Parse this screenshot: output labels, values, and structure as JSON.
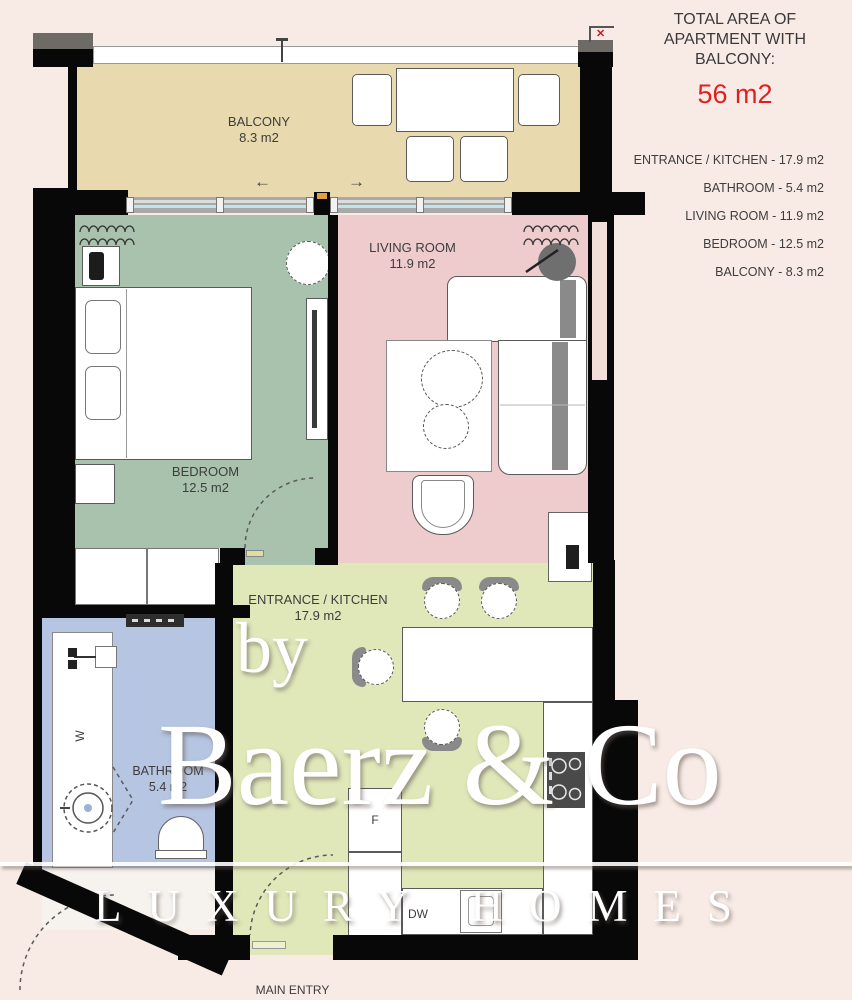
{
  "summary": {
    "title": "TOTAL AREA OF APARTMENT WITH BALCONY:",
    "total": "56 m2",
    "total_color": "#e02020"
  },
  "legend": {
    "items": [
      "ENTRANCE / KITCHEN - 17.9 m2",
      "BATHROOM - 5.4 m2",
      "LIVING ROOM - 11.9 m2",
      "BEDROOM - 12.5 m2",
      "BALCONY - 8.3 m2"
    ]
  },
  "rooms": {
    "balcony": {
      "name": "BALCONY",
      "area": "8.3 m2",
      "color": "#e9d9ae"
    },
    "living": {
      "name": "LIVING ROOM",
      "area": "11.9 m2",
      "color": "#eeccce"
    },
    "bedroom": {
      "name": "BEDROOM",
      "area": "12.5 m2",
      "color": "#a9c2ae"
    },
    "kitchen": {
      "name": "ENTRANCE / KITCHEN",
      "area": "17.9 m2",
      "color": "#e0e8ba"
    },
    "bathroom": {
      "name": "BATHROOM",
      "area": "5.4 m2",
      "color": "#b6c5e2"
    }
  },
  "labels": {
    "main_entry": "MAIN ENTRY",
    "fridge": "F",
    "dishwasher": "DW",
    "washer": "W",
    "arrow_left": "←",
    "arrow_right": "→",
    "close_mark": "✕"
  },
  "watermark": {
    "by": "by",
    "brand": "Baerz & Co",
    "tagline": "LUXURY HOMES"
  }
}
